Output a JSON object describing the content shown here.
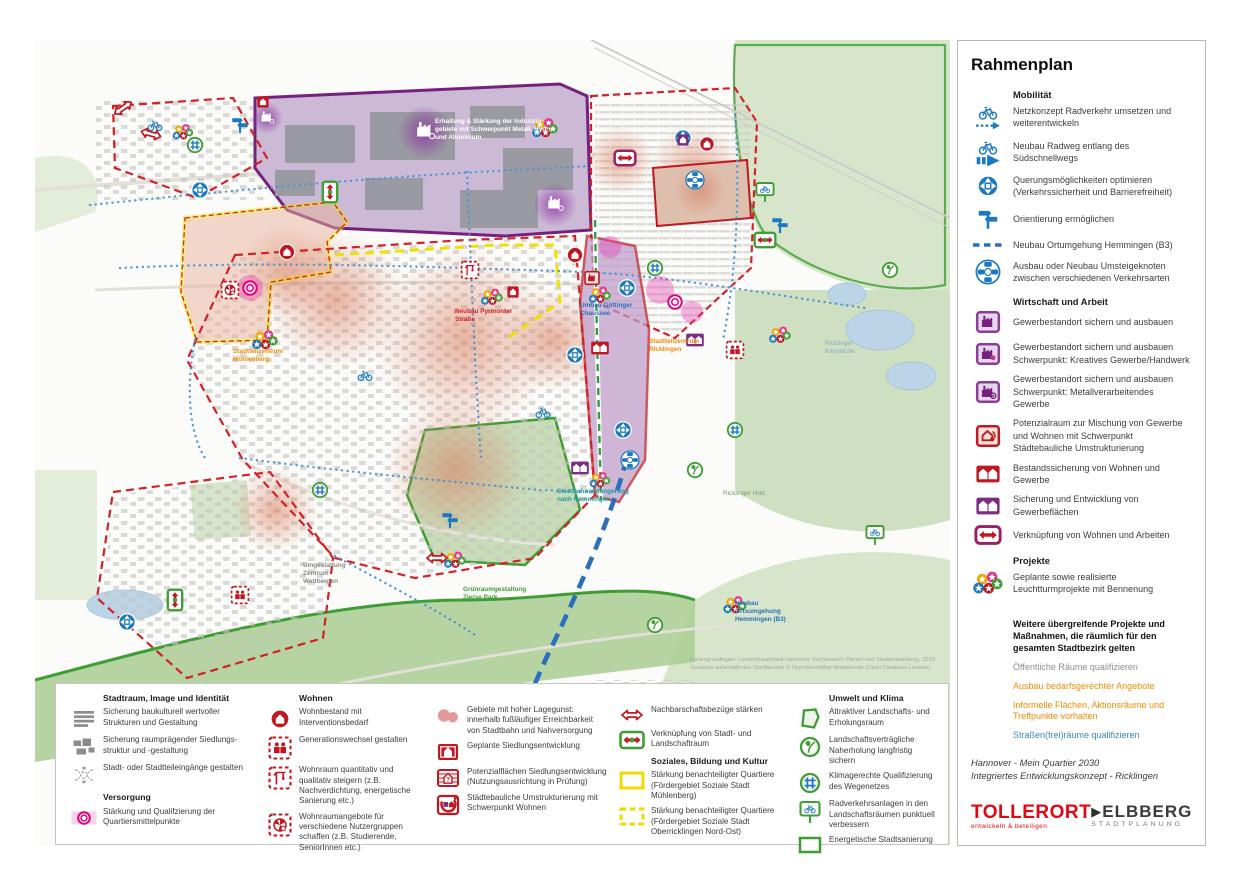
{
  "right_panel": {
    "title": "Rahmenplan",
    "mobilitaet": {
      "header": "Mobilität",
      "items": [
        {
          "icon": "bike-dotted-arrow-icon",
          "label": "Netzkonzept Radverkehr umsetzen und weiterentwickeln"
        },
        {
          "icon": "bike-solid-arrow-icon",
          "label": "Neubau Radweg entlang des Südschnellwegs"
        },
        {
          "icon": "crossing-circle-icon",
          "label": "Querungsmöglichkeiten optimieren (Verkehrssicherheit und Barrierefreiheit)"
        },
        {
          "icon": "signpost-icon",
          "label": "Orientierung ermöglichen"
        },
        {
          "icon": "blue-dashed-line-icon",
          "label": "Neubau Ortumgehung Hemmingen (B3)"
        },
        {
          "icon": "transfer-hub-icon",
          "label": "Ausbau oder Neubau Umsteigeknoten zwischen verschiedenen Verkehrsarten"
        }
      ]
    },
    "wirtschaft": {
      "header": "Wirtschaft und Arbeit",
      "items": [
        {
          "icon": "factory-purple-icon",
          "label": "Gewerbestandort sichern und ausbauen"
        },
        {
          "icon": "factory-creative-icon",
          "label": "Gewerbestandort sichern und ausbauen Schwerpunkt: Kreatives Gewerbe/Handwerk"
        },
        {
          "icon": "factory-metal-icon",
          "label": "Gewerbestandort sichern und ausbauen Schwerpunkt: Metallverarbeitendes Gewerbe"
        },
        {
          "icon": "mixed-use-potential-icon",
          "label": "Potenzialraum zur Mischung von Gewerbe und Wohnen mit Schwerpunkt Städtebauliche Umstrukturierung"
        },
        {
          "icon": "two-houses-red-icon",
          "label": "Bestandssicherung von Wohnen und Gewerbe"
        },
        {
          "icon": "two-houses-purple-icon",
          "label": "Sicherung und Entwicklung von Gewerbeflächen"
        },
        {
          "icon": "live-work-link-icon",
          "label": "Verknüpfung von Wohnen und Arbeiten"
        }
      ]
    },
    "projekte": {
      "header": "Projekte",
      "items": [
        {
          "icon": "project-stars-icon",
          "label": "Geplante sowie realisierte Leuchtturmprojekte mit Bennenung"
        }
      ]
    },
    "citywide": {
      "title": "Weitere übergreifende Projekte und Maßnahmen, die räumlich für den gesamten Stadtbezirk gelten",
      "items": [
        {
          "label": "Öffentliche Räume qualifizieren",
          "color": "#8d8d8d"
        },
        {
          "label": "Ausbau bedarfsgerechter Angebote",
          "color": "#f08c00"
        },
        {
          "label": "Informelle Flächen, Aktionsräume und Treffpunkte vorhalten",
          "color": "#f08c00"
        },
        {
          "label": "Straßen(frei)räume qualifizieren",
          "color": "#3a87c8"
        }
      ]
    },
    "footer": {
      "line1": "Hannover - Mein Quartier 2030",
      "line2": "Integriertes Entwicklungskonzept - Ricklingen"
    },
    "logos": {
      "tollerort": {
        "name": "TOLLERORT",
        "tagline": "entwickeln & beteiligen"
      },
      "elbberg": {
        "mark": "▶",
        "name": "ELBBERG",
        "tagline": "STADTPLANUNG"
      }
    }
  },
  "bottom_legend": {
    "col1": {
      "header1": "Stadtraum, Image und Identität",
      "items": [
        {
          "icon": "heritage-lines-icon",
          "label": "Sicherung baukulturell wertvoller Strukturen und Gestaltung"
        },
        {
          "icon": "settlement-blocks-icon",
          "label": "Sicherung raumprägender Siedlungs­struktur und -gestaltung"
        },
        {
          "icon": "district-gateway-icon",
          "label": "Stadt- oder Stadtteileingänge gestalten"
        }
      ],
      "header2": "Versorgung",
      "items2": [
        {
          "icon": "quarter-center-icon",
          "label": "Stärkung und Qualifzierung der Quartiersmittelpunkte"
        }
      ]
    },
    "col2": {
      "header": "Wohnen",
      "items": [
        {
          "icon": "housing-intervention-icon",
          "label": "Wohnbestand mit Interventionsbedarf"
        },
        {
          "icon": "generation-change-icon",
          "label": "Generationswechsel gestalten"
        },
        {
          "icon": "housing-increase-icon",
          "label": "Wohnraum quantitativ und qualitativ steigern (z.B. Nachverdichtung, energetische Sanierung etc.)"
        },
        {
          "icon": "housing-offers-icon",
          "label": "Wohnraumangebote für verschiedene Nutzergruppen schaffen (z.B. Studierende, SeniorInnen etc.)"
        }
      ]
    },
    "col3": {
      "items": [
        {
          "icon": "location-advantage-icon",
          "label": "Gebiete mit hoher Lagegunst: innerhalb fußläufiger Erreichbarkeit von Stadtbahn und Nahversorgung"
        },
        {
          "icon": "planned-settlement-icon",
          "label": "Geplante Siedlungsentwicklung"
        },
        {
          "icon": "potential-areas-icon",
          "label": "Potenzialflächen Siedlungsentwicklung (Nutzungsausrichtung in Prüfung)"
        },
        {
          "icon": "urban-restructuring-icon",
          "label": "Städtebauliche Umstrukturierung mit Schwerpunkt Wohnen"
        }
      ]
    },
    "col4": {
      "items": [
        {
          "icon": "neighborhood-arrow-icon",
          "label": "Nachbarschaftsbezüge stärken"
        },
        {
          "icon": "city-landscape-link-icon",
          "label": "Verknüpfung von Stadt- und Landschaftraum"
        }
      ],
      "header": "Soziales, Bildung und Kultur",
      "items2": [
        {
          "icon": "yellow-solid-frame-icon",
          "label": "Stärkung benachteiligter Quartiere (Fördergebiet Soziale Stadt Mühlenberg)"
        },
        {
          "icon": "yellow-dashed-frame-icon",
          "label": "Stärkung benachteiligter Quartiere (Fördergebiet Soziale Stadt Oberricklingen Nord-Ost)"
        }
      ]
    },
    "col5": {
      "header": "Umwelt und Klima",
      "items": [
        {
          "icon": "landscape-area-icon",
          "label": "Attraktiver Landschafts- und Erholungsraum"
        },
        {
          "icon": "nature-recreation-icon",
          "label": "Landschaftsverträgliche Naherholung langfristig sichern"
        },
        {
          "icon": "climate-paths-icon",
          "label": "Klimagerechte Qualifizierung des Wegenetzes"
        },
        {
          "icon": "bike-landscape-icon",
          "label": "Radverkehrsanlagen in den Landschafts­räumen punktuell verbessern"
        },
        {
          "icon": "energetic-renewal-icon",
          "label": "Energetische Stadtsanierung"
        }
      ]
    }
  },
  "map": {
    "labels": [
      {
        "text": "Erhaltung & Stärkung der Industrie­gebiete mit Schwerpunkt Metall, Hydro und Aluminium"
      },
      {
        "text": "Neubau Pyrmonter Straße"
      },
      {
        "text": "Umbau Göttinger Chaussee"
      },
      {
        "text": "Stadtteilzentrum Mühlenberg"
      },
      {
        "text": "Stadtteilzentrum Ricklingen"
      },
      {
        "text": "Umgestaltung Zentrum Wettbergen"
      },
      {
        "text": "Stadtbahnverlängerung nach Hemmingen"
      },
      {
        "text": "Grünraumgestaltung Zierse Park"
      },
      {
        "text": "Neubau Ortsumgehung Hemmingen (B3)"
      },
      {
        "text": "Ricklinger Holz"
      },
      {
        "text": "Ricklinger Kiesteiche"
      }
    ],
    "attribution": [
      "Kartengrundlagen: Landeshauptstadt Hannover, Fachbereich Planen und Stadtentwicklung, 2018.",
      "Gebäude außerhalb des Stadtbezirks © OpenStreetMap-Mitwirkende (Open Database License)"
    ]
  },
  "colors": {
    "blue": "#1c79c0",
    "purple": "#76217e",
    "red": "#d42027",
    "green": "#3e9e33",
    "yellow": "#f0e000",
    "orange": "#f08c00",
    "pink": "#e83cb5"
  }
}
